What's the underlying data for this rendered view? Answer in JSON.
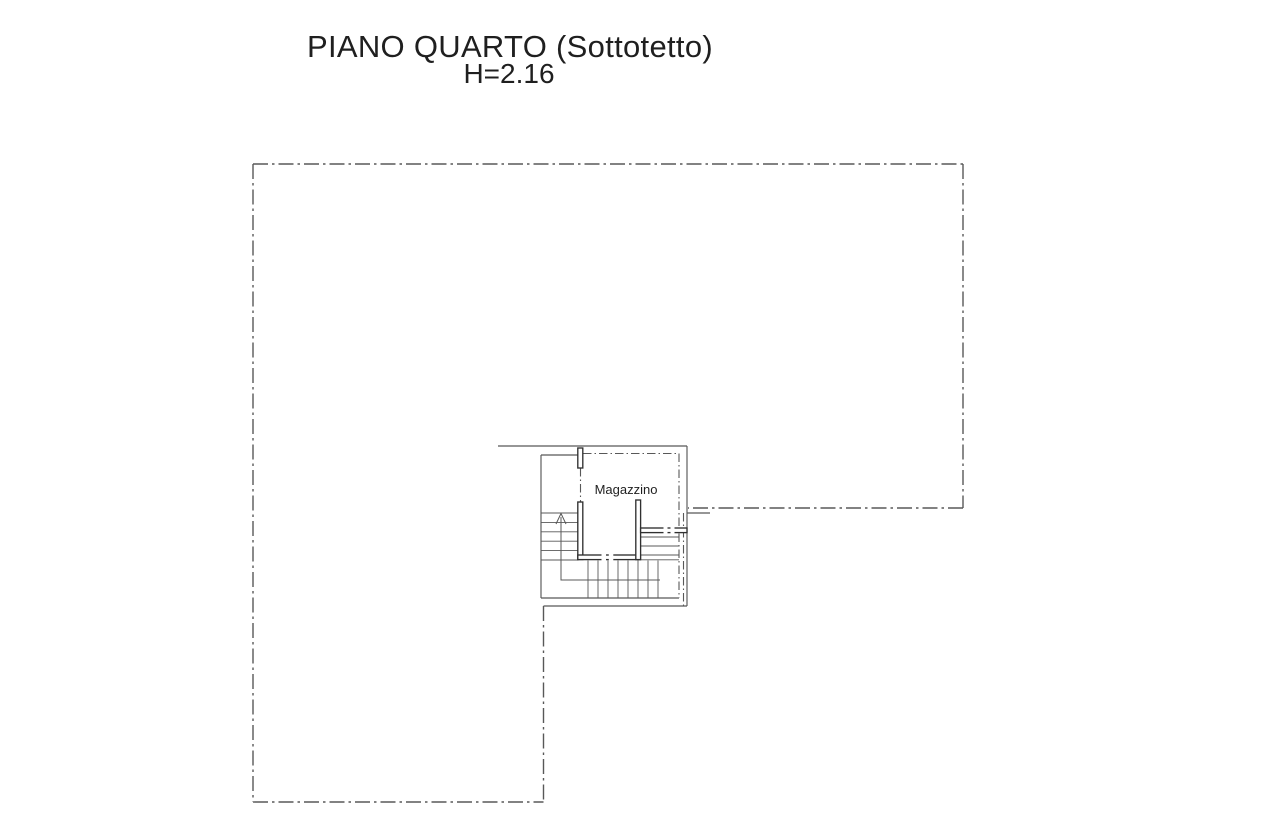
{
  "header": {
    "title": "PIANO QUARTO (Sottotetto)",
    "subtitle": "H=2.16"
  },
  "floor_plan": {
    "room_label": "Magazzino",
    "colors": {
      "outline": "#585858",
      "wall": "#303030",
      "text": "#1f1f1f",
      "paper": "#ffffff"
    }
  }
}
